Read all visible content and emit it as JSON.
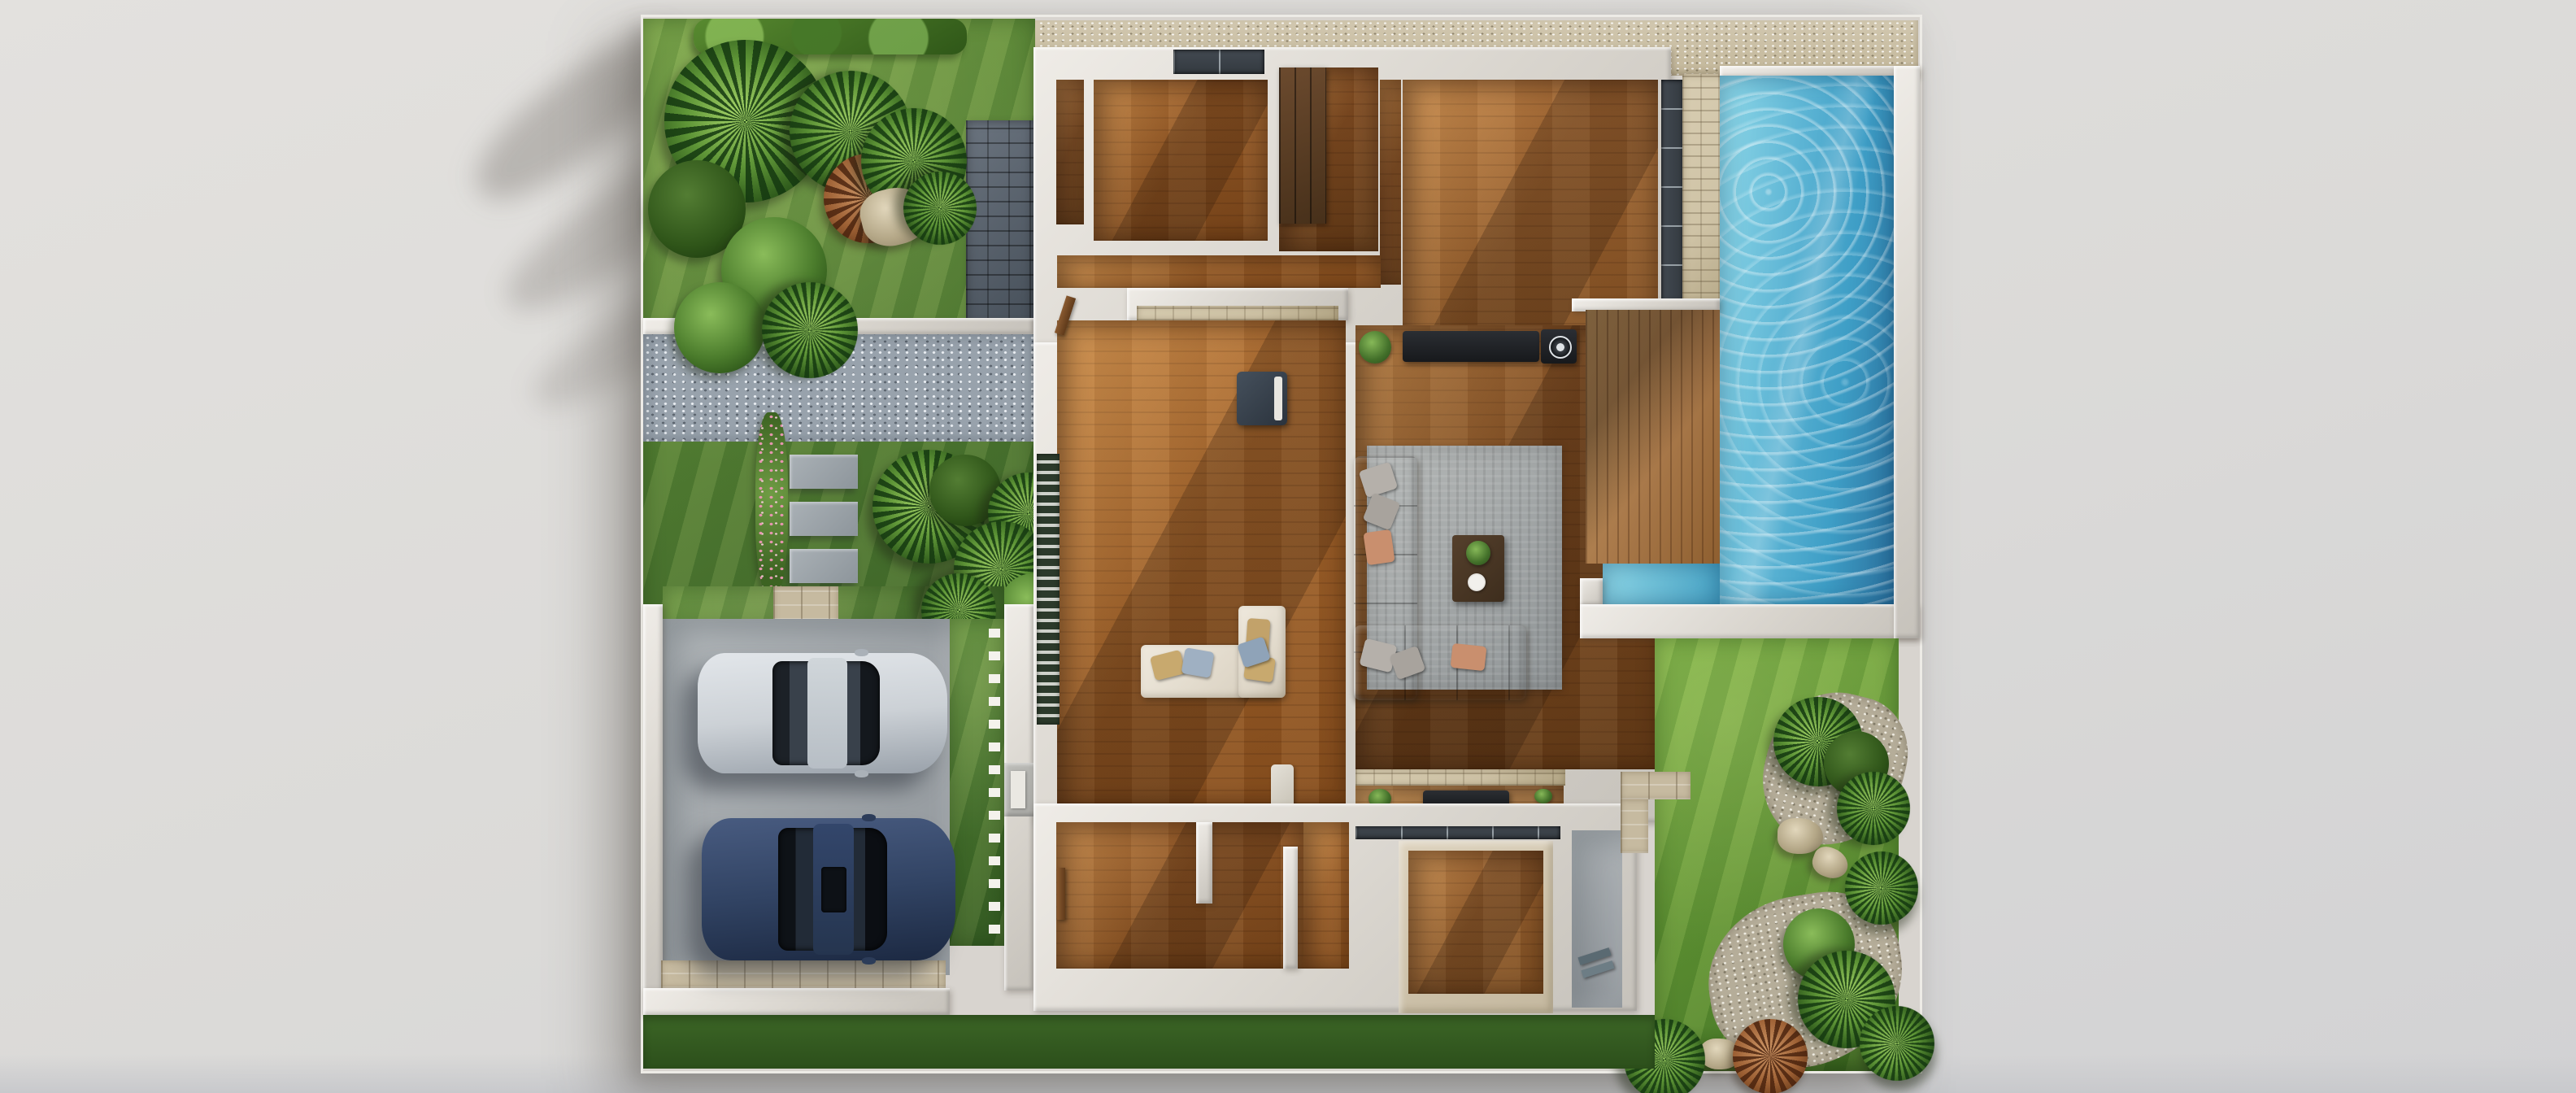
{
  "scene": {
    "type": "3d-architectural-floor-plan-render",
    "view": "top-down",
    "label": "Modern single-storey villa cutaway plan with garden, driveway and swimming pool",
    "lighting": "daylight with soft diagonal shadows"
  },
  "palette": {
    "background": "#e3e1de",
    "backgroundBottom": "#c8c9cc",
    "wall": "#d8d4cd",
    "wallHi": "#efece7",
    "gravelTop": "#cdc2a9",
    "pebbleBlue": "#98a2ac",
    "stoneDarkA": "#6b747f",
    "stoneDarkB": "#454e58",
    "stoneBeige": "#cfc3a6",
    "concrete": "#a3a8ac",
    "paver": "#c6baa0",
    "water1": "#8fd8e8",
    "water2": "#3e9ec6",
    "water3": "#2a6f9c",
    "deckA": "#c49a63",
    "deckB": "#8e5f30",
    "rug": "#a3a6a6",
    "sofa": "#908c88",
    "carSilver": "#ccd1d6",
    "carNavy": "#314363",
    "windowDark": "#33393f"
  },
  "inventory": {
    "pool": {
      "label": "swimming pool",
      "shape": "rectangular with corner deck",
      "water_hex": "#3e9ec6"
    },
    "deck": {
      "label": "wooden pool deck"
    },
    "cars": [
      {
        "label": "silver sedan",
        "body_hex": "#ccd1d6"
      },
      {
        "label": "navy sedan",
        "body_hex": "#314363"
      }
    ],
    "rooms": [
      "bedroom-top-left",
      "bathroom",
      "wardrobe-room",
      "master-bedroom",
      "central-hall",
      "living-room",
      "bedroom-bottom-left",
      "bedroom-bottom-right",
      "terrace"
    ],
    "furniture": [
      "gray-sectional-sofa",
      "area-rug",
      "coffee-table",
      "tv-console",
      "ac-unit",
      "cream-corner-bench",
      "dark-armchair",
      "wardrobe",
      "outdoor-console"
    ],
    "landscape": [
      "tropical-garden",
      "stone-wall",
      "gravel-court",
      "stepping-stones",
      "driveway",
      "lawn",
      "pebble-path",
      "palms",
      "hedge",
      "flower-bush"
    ]
  }
}
